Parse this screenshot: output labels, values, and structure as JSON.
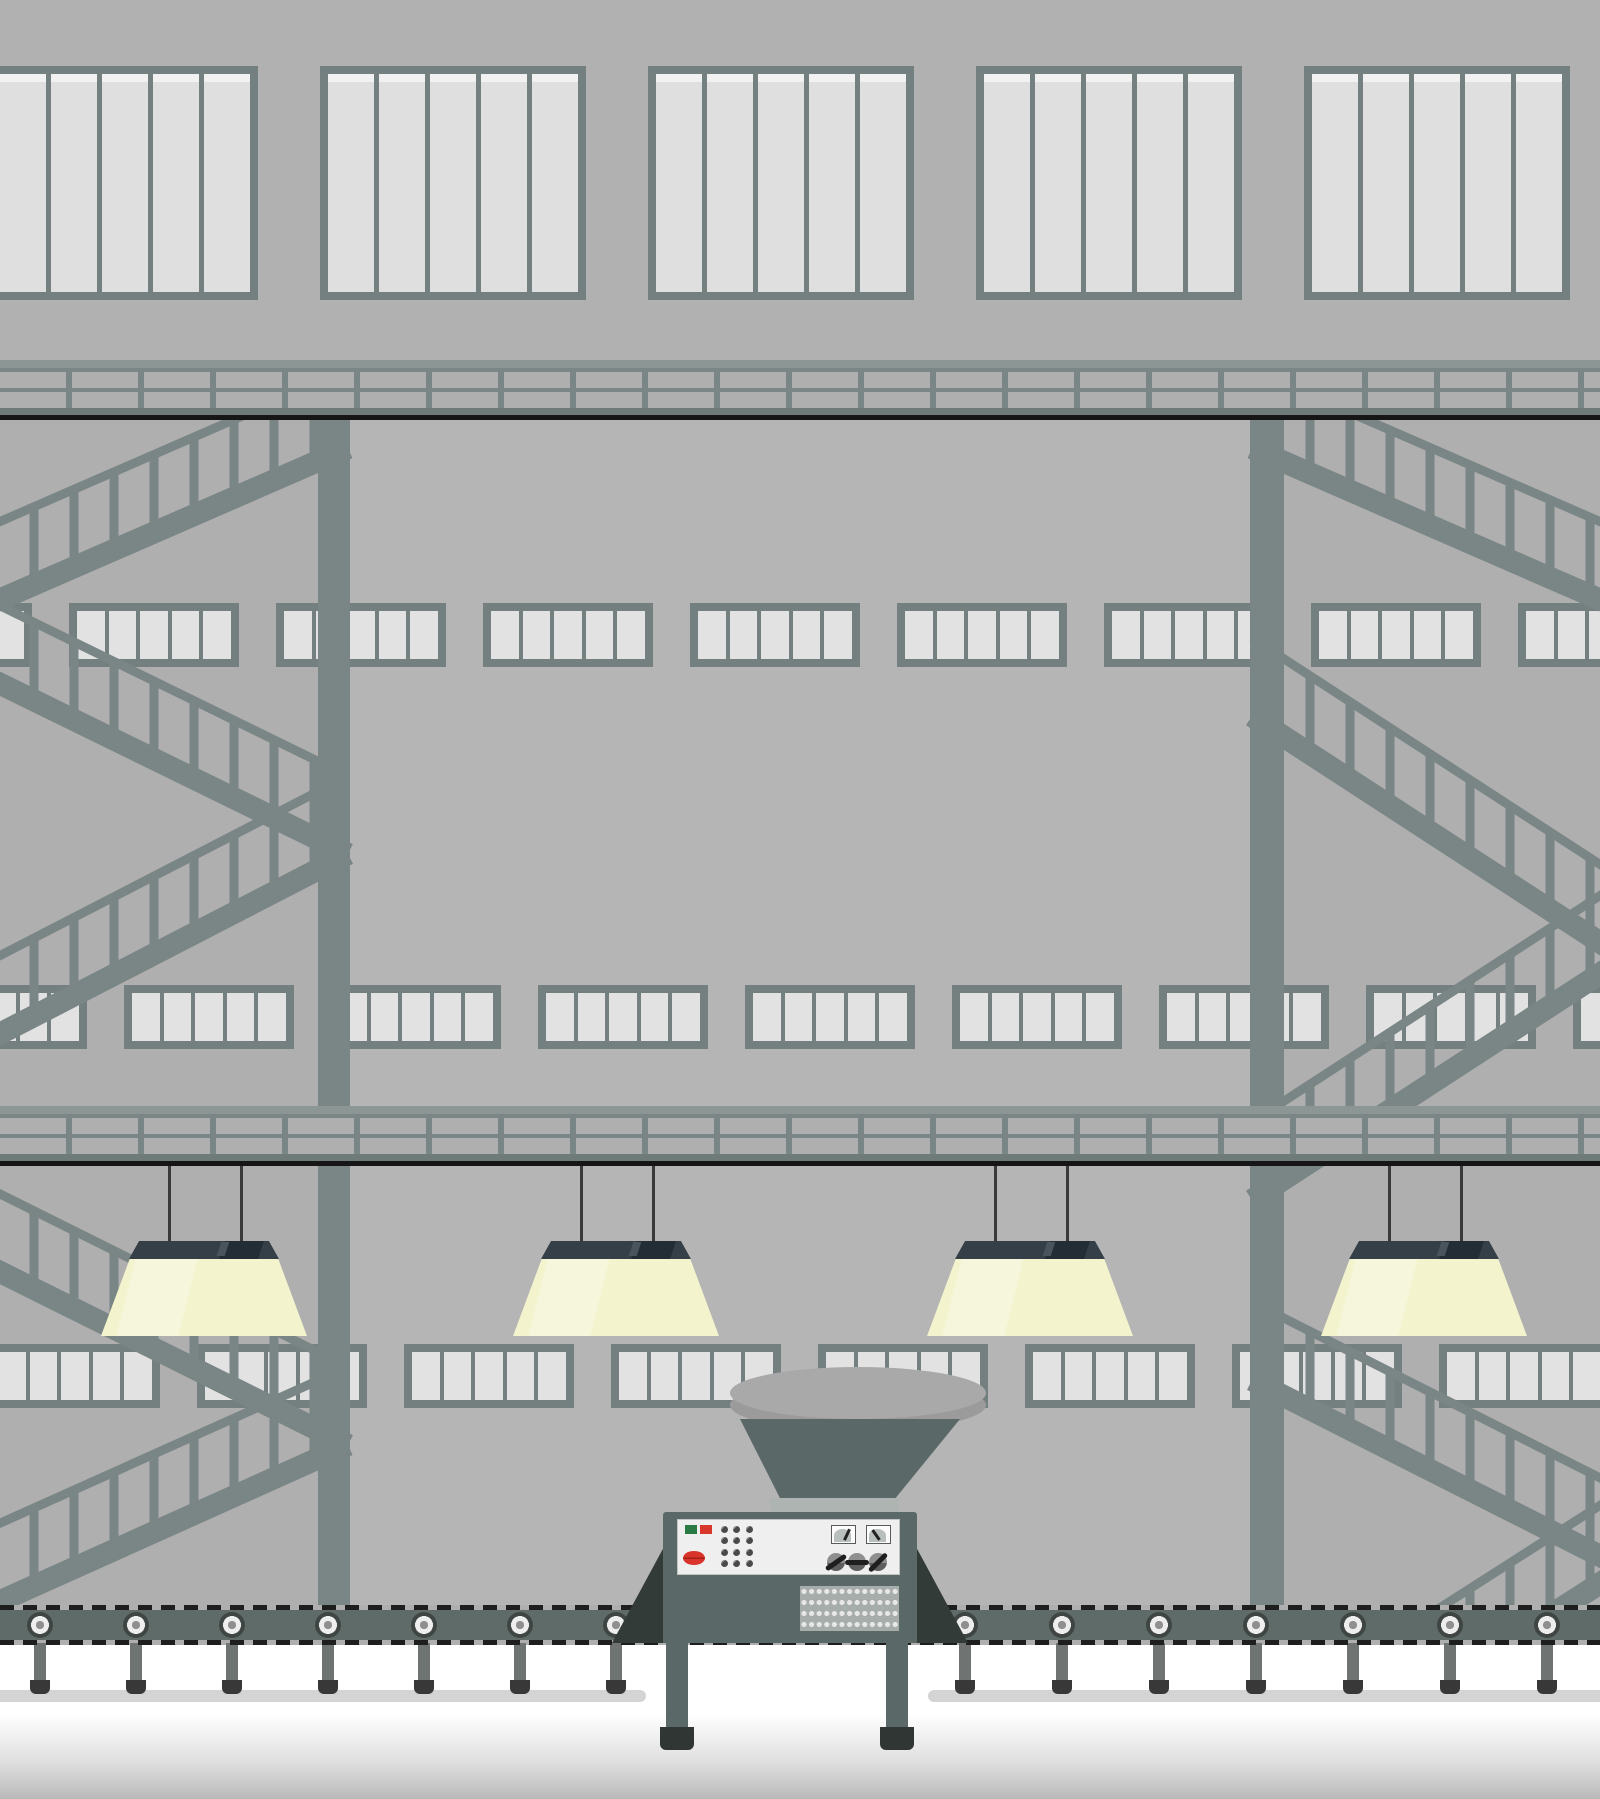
{
  "scene": {
    "description": "flat vector illustration of a factory interior with windows, catwalks, stairs, hanging lamps, hopper machine and conveyor belt",
    "colors": {
      "wall": "#AFAFAF",
      "wall_top": "#B1B1B1",
      "wall_center": "#B5B5B5",
      "steel": "#7A8685",
      "steel_light": "#8C9695",
      "walkway": "#6F7B79",
      "frame": "#74807F",
      "pane": "#DFDFDF",
      "pane_highlight": "#F1F1F1",
      "band_pane": "#E2E2E2",
      "black_line": "#161616",
      "lamp_shade": "#353F47",
      "lamp_shade_dark": "#232D35",
      "lamp_glow": "#F3F3CD",
      "wire": "#3A3A3A",
      "belt": "#5F6B69",
      "belt_dash": "#1E1E1E",
      "roller_outer": "#3E4543",
      "roller_ring": "#EDEDED",
      "roller_hub": "#8F8F8F",
      "roller_leg": "#6F7472",
      "roller_cap": "#383838",
      "shadow_strip": "#D4D4D4",
      "machine_body": "#5A6967",
      "machine_flank": "#333B39",
      "neck": "#AEB4B2",
      "hopper_top": "#A9A9A9",
      "hopper_rim": "#9B9B9B",
      "panel_bg": "#EFEFEF",
      "panel_border": "#C2C2C2",
      "btn_green": "#2A7A45",
      "btn_red": "#D8372C",
      "lens_red": "#D8342B",
      "lens_line": "#A32015",
      "knob": "#4A4A4A",
      "gauge_bg": "#FCFCFC",
      "gauge_border": "#5A5A5A",
      "gauge_arc": "#B9BFBD",
      "needle": "#222222",
      "lever_body": "#8F8F8F",
      "lever_bar": "#1F1F1F",
      "grille_bg": "#A6ADAB",
      "grille_dot": "#E7E7E7",
      "floor_top": "#FFFFFF",
      "floor_bottom": "#B9B9B9"
    },
    "top_windows": {
      "count": 5,
      "panes_per_window": 5,
      "y": 66,
      "height": 234,
      "width": 266,
      "xs": [
        -8,
        320,
        648,
        976,
        1304
      ]
    },
    "bridges": {
      "count": 2,
      "ys": [
        360,
        1106
      ],
      "height": 60,
      "post_period": 72,
      "post_gap": 6
    },
    "columns": [
      {
        "x": 318,
        "w": 32
      },
      {
        "x": 1250,
        "w": 34
      }
    ],
    "column_span": {
      "top": 420,
      "bottom": 1605
    },
    "window_bands": {
      "height": 64,
      "unit_width": 170,
      "panes_per_unit": 5,
      "rows": [
        {
          "y": 603,
          "unit_xs": [
            -138,
            69,
            276,
            483,
            690,
            897,
            1104,
            1311,
            1518
          ]
        },
        {
          "y": 985,
          "unit_xs": [
            -83,
            124,
            331,
            538,
            745,
            952,
            1159,
            1366,
            1573
          ]
        },
        {
          "y": 1344,
          "unit_xs": [
            -10,
            197,
            404,
            611,
            818,
            1025,
            1232,
            1439
          ]
        }
      ]
    },
    "stairs": {
      "stringer_w": 22,
      "rail_w": 9,
      "rail_offset": 78,
      "baluster_w": 9,
      "baluster_spacing": 40,
      "clip": {
        "top": 420,
        "bottom": 1605
      },
      "flights_left": [
        [
          348,
          448,
          -24,
          610
        ],
        [
          -24,
          672,
          348,
          854
        ],
        [
          348,
          854,
          -24,
          1046
        ],
        [
          -24,
          1260,
          348,
          1445
        ],
        [
          348,
          1445,
          -24,
          1612
        ]
      ],
      "flights_right": [
        [
          1252,
          448,
          1624,
          610
        ],
        [
          1252,
          716,
          1624,
          958
        ],
        [
          1624,
          958,
          1252,
          1200
        ],
        [
          1252,
          1380,
          1624,
          1568
        ],
        [
          1624,
          1568,
          1252,
          1806
        ]
      ]
    },
    "lamps": {
      "count": 4,
      "centers": [
        204,
        616,
        1030,
        1424
      ],
      "wire_top": 1166,
      "wire_bottom": 1242,
      "wire_dx": 36,
      "shade": {
        "y": 1241,
        "w": 150,
        "h": 18,
        "top_w": 130
      },
      "glow": {
        "y": 1258,
        "w": 206,
        "h": 78,
        "top_w": 148
      }
    },
    "conveyor": {
      "band_y": 1605,
      "band_h": 40,
      "dash_h": 5,
      "roller_cy": 1625,
      "roller_r": 13,
      "roller_xs": [
        40,
        136,
        232,
        328,
        424,
        520,
        616,
        965,
        1062,
        1159,
        1256,
        1353,
        1450,
        1547
      ],
      "leg": {
        "w": 12,
        "top": 1643,
        "bottom": 1682
      },
      "cap": {
        "w": 20,
        "top": 1680,
        "h": 14
      },
      "shadow_strips": [
        {
          "x": -20,
          "w": 666
        },
        {
          "x": 928,
          "w": 692
        }
      ],
      "shadow_y": 1690,
      "shadow_h": 12
    },
    "machine": {
      "hopper_ellipse": {
        "x": 730,
        "y": 1367,
        "w": 256,
        "h": 52
      },
      "hopper_rim": {
        "x": 730,
        "y": 1379,
        "w": 256,
        "h": 52
      },
      "funnel": {
        "top_x1": 740,
        "top_x2": 960,
        "top_y": 1419,
        "bot_x1": 781,
        "bot_x2": 894,
        "bot_y": 1500
      },
      "neck": {
        "x": 770,
        "y": 1498,
        "w": 128,
        "h": 18
      },
      "body": {
        "x": 663,
        "y": 1512,
        "w": 254,
        "h": 131
      },
      "flank_w": 51,
      "flank_top": 1545,
      "legs": [
        {
          "x": 666
        },
        {
          "x": 886
        }
      ],
      "leg_w": 22,
      "leg_top": 1643,
      "leg_bottom": 1732,
      "feet_w": 34,
      "feet_y": 1727,
      "feet_h": 23,
      "panel": {
        "x": 677,
        "y": 1519,
        "w": 223,
        "h": 56
      },
      "btn_green": {
        "x": 685,
        "y": 1525,
        "w": 12,
        "h": 9
      },
      "btn_red": {
        "x": 700,
        "y": 1525,
        "w": 12,
        "h": 9
      },
      "lens": {
        "cx": 694,
        "cy": 1558,
        "rx": 11,
        "ry": 7
      },
      "knob_grid": {
        "x0": 724,
        "y0": 1529,
        "dx": 12.5,
        "dy": 11.5,
        "cols": 3,
        "rows": 4,
        "r": 3.5
      },
      "gauges": [
        {
          "x": 831,
          "needle_deg": 25
        },
        {
          "x": 866,
          "needle_deg": -35
        }
      ],
      "gauge_y": 1525,
      "gauge_w": 25,
      "gauge_h": 19,
      "levers": [
        {
          "cx": 836,
          "deg": -35
        },
        {
          "cx": 857,
          "deg": 0
        },
        {
          "cx": 878,
          "deg": -45
        }
      ],
      "lever_cy": 1562,
      "lever_r": 9,
      "grille": {
        "x": 800,
        "y": 1586,
        "w": 99,
        "h": 45
      }
    },
    "floor": {
      "y": 1645
    },
    "black_lines": [
      415,
      1161
    ]
  }
}
